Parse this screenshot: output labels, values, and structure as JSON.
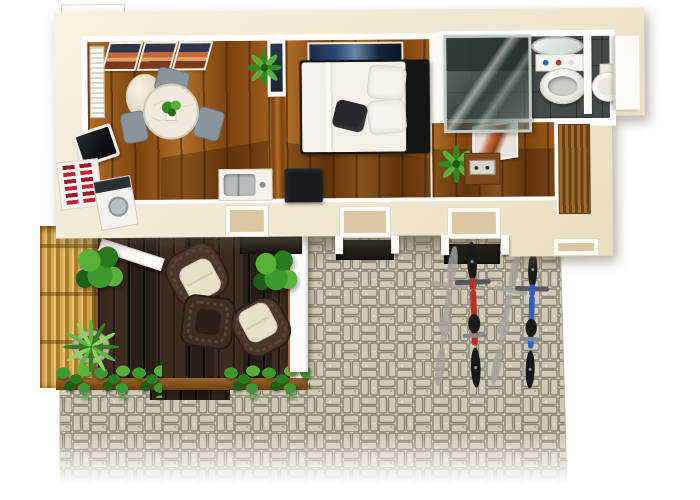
{
  "scene": {
    "description": "Top-down 3D render of a one-bedroom studio floor plan with timber deck, bamboo fence, hedge border, interlocking-paver courtyard and two parked bicycles",
    "background": "#ffffff"
  },
  "palette": {
    "wall": "#f1e7d0",
    "wall-hi": "#f8f2e2",
    "white": "#ffffff",
    "wood": "#9a5a1c",
    "wood-dk": "#7c430e",
    "wood-lt": "#b06f28",
    "deck": "#2e221a",
    "bamboo": "#d8a94e",
    "bamboo-dk": "#a97f2c",
    "paver": "#cbc4af",
    "paver-line": "#8d8574",
    "green-l": "#58b23a",
    "green-m": "#3c9a2e",
    "green-d": "#2a7a1e",
    "green-xd": "#1f5e14",
    "wicker": "#4a362a",
    "wicker-dk": "#2e2019",
    "cushion": "#e9e0ca",
    "mattress": "#f3f1e7",
    "bed-frame": "#141517",
    "bath-floor": "#45494a",
    "glass-frame": "#c2c9c4",
    "art-orange": "#c4683a",
    "art-navy": "#1c2b4a",
    "bike-red": "#b33226",
    "bike-blue": "#2f5ec4",
    "mat": "#1f1c17",
    "shadow-patch": "rgba(48,24,4,.34)",
    "slate": "#8a949c",
    "counter": "#f4f2ea",
    "sink": "#b7bcbe",
    "appliance-dark": "#2b3036",
    "red-items": "#c0243a",
    "table-wood": "#7c4a1d",
    "slat-a": "#a06a2e",
    "slat-b": "#6b4113"
  },
  "rooms": [
    {
      "id": "living-dining",
      "floor": "wood",
      "objects": [
        "sunset-art-triptych",
        "wall-radiator",
        "water-heater-cylinder",
        "round-marble-dining-table",
        "dining-chairs-x3",
        "table-centerpiece-plant",
        "wall-tv",
        "kitchen-shelf-red-dishes",
        "kitchen-appliance",
        "counter-with-sink",
        "potted-plant"
      ]
    },
    {
      "id": "bedroom",
      "floor": "wood",
      "objects": [
        "panoramic-wall-art",
        "double-bed",
        "white-pillows-x2",
        "dark-accent-pillow",
        "dark-headboard",
        "black-ottoman",
        "wardrobe-panel"
      ]
    },
    {
      "id": "hallway",
      "floor": "wood",
      "objects": [
        "framed-art",
        "potted-plant",
        "side-table-with-radio",
        "wood-slat-bench"
      ]
    },
    {
      "id": "bathroom",
      "floor": "dark-tile",
      "objects": [
        "glass-shower",
        "oval-mirror",
        "toiletry-shelf",
        "pedestal-washbasin",
        "partition-wall",
        "toilet",
        "open-door"
      ]
    }
  ],
  "outdoor": {
    "deck": {
      "surface": "dark-timber-planks",
      "objects": [
        "wicker-armchair-1",
        "wicker-armchair-2",
        "wicker-coffee-table",
        "bush-left",
        "bush-right",
        "agave-in-pot",
        "open-deck-door",
        "door-mat"
      ]
    },
    "courtyard": {
      "surface": "interlocking-pavers",
      "objects": [
        "red-bicycle",
        "blue-bicycle",
        "bicycle-shadows",
        "door-mat-1",
        "door-mat-2"
      ]
    },
    "boundary": [
      "bamboo-fence",
      "hedge-row-left",
      "hedge-row-right",
      "timber-planter-edge",
      "deck-courtyard-divider-wall"
    ]
  },
  "exterior_details": [
    "rooftop-white-box",
    "window-sill-1",
    "window-sill-2",
    "window-sill-3",
    "window-sill-4"
  ]
}
